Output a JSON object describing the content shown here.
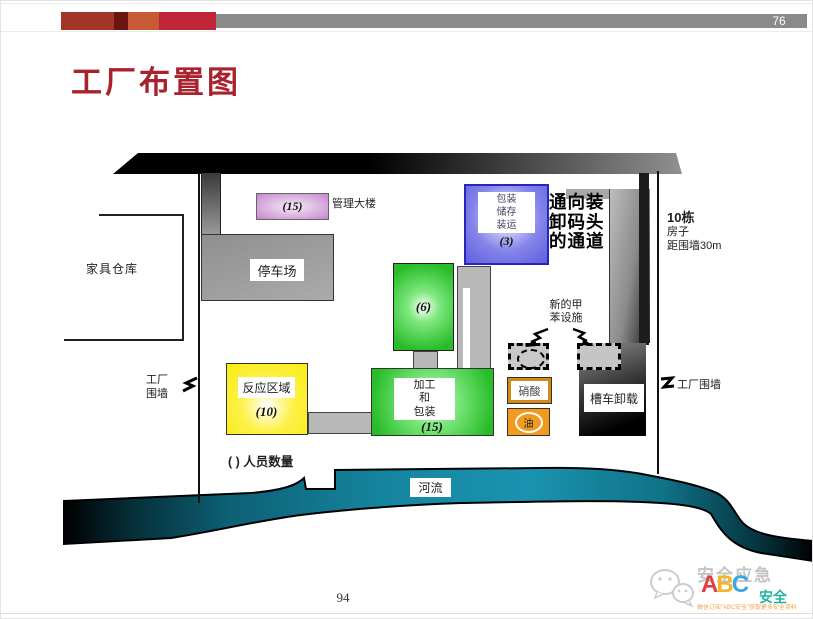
{
  "slide": {
    "page_badge": "76",
    "page_number": "94",
    "title": "工厂布置图"
  },
  "colors": {
    "title_red": "#a8222e",
    "bar_gray": "#8a8a8a",
    "bar_blocks": [
      "#a23527",
      "#6a1510",
      "#c75b35",
      "#bf2638"
    ],
    "river_teal": "#1a93b0",
    "reaction_yellow": "#f8ec13",
    "process_green": "#28bc28",
    "packaging_blue": "#5e5ee0",
    "management_purple": "#cf9ad6",
    "oil_orange": "#f29a1d",
    "nitric_border_orange": "#d08a18"
  },
  "diagram": {
    "furniture_warehouse_label": "家具仓库",
    "management": {
      "count": "(15)",
      "label": "管理大楼"
    },
    "parking_label": "停车场",
    "packaging": {
      "line1": "包装",
      "line2": "储存",
      "line3": "装运",
      "count": "(3)"
    },
    "passage": {
      "line1": "通向装",
      "line2": "卸码头",
      "line3": "的通道"
    },
    "houses": {
      "line1": "10栋",
      "line2": "房子",
      "line3": "距围墙30m"
    },
    "wall_left": {
      "line1": "工厂",
      "line2": "围墙"
    },
    "wall_right_label": "工厂围墙",
    "unit6_count": "(6)",
    "toluene": {
      "line1": "新的甲",
      "line2": "苯设施"
    },
    "reaction": {
      "label": "反应区域",
      "count": "(10)"
    },
    "processing": {
      "line1": "加工",
      "line2": "和",
      "line3": "包装",
      "count": "(15)"
    },
    "nitric_label": "硝酸",
    "oil_label": "油",
    "tank_label": "槽车卸载",
    "legend": "( ) 人员数量",
    "river_label": "河流"
  },
  "logo": {
    "brand": "安全应急",
    "letter_a": "A",
    "letter_b": "B",
    "letter_c": "C",
    "suffix": "安全",
    "tagline": "微信订阅\"ABC安全\"获取更多安全资料"
  }
}
